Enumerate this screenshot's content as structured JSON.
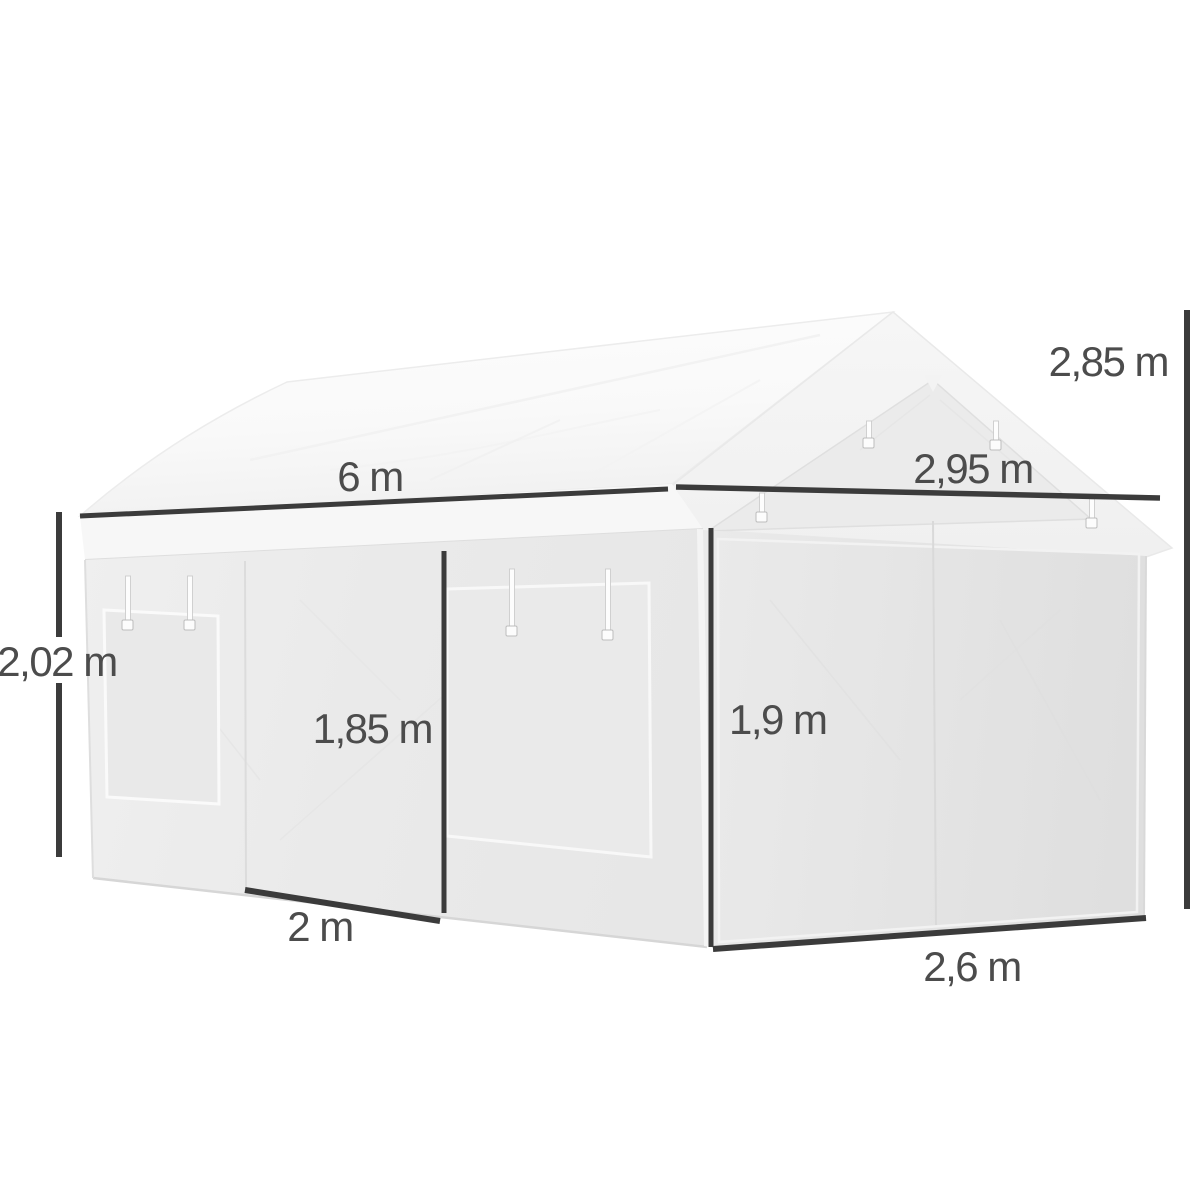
{
  "diagram": {
    "type": "product-dimension-diagram",
    "subject": "White gabled party tent / carport shelter with roll-up side door, side window panel and full-width front door, shown with metric dimension lines",
    "unit_system": "metric",
    "colors": {
      "background": "#ffffff",
      "dimension_line": "#3b3b3b",
      "label_text": "#4c4c4c",
      "roof": "#fafafa",
      "gable": "#f2f2f2",
      "side_wall": "#e9e9e9",
      "front_wall": "#e4e4e4"
    },
    "measurements": {
      "total_length": "6 m",
      "gable_width": "2,95 m",
      "total_height": "2,85 m",
      "wall_height": "2,02 m",
      "side_door_height": "1,85 m",
      "front_door_height": "1,9 m",
      "side_door_width": "2 m",
      "front_door_width": "2,6 m"
    }
  }
}
